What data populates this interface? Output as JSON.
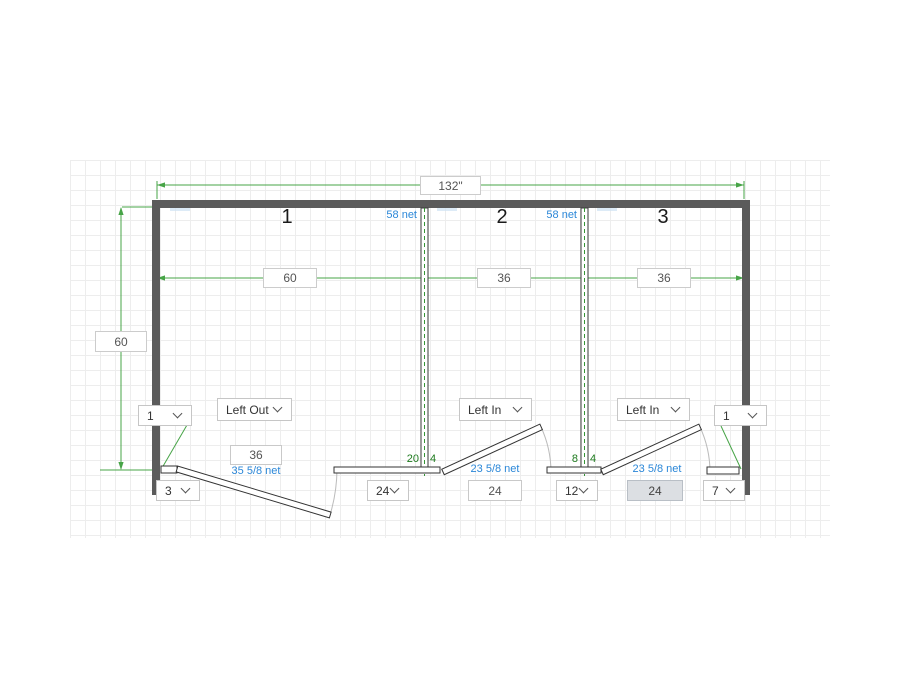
{
  "colors": {
    "wall_gray": "#5b5b5b",
    "dimension_green": "#47a447",
    "net_label_blue": "#2b87d8",
    "pilaster_label_green": "#1d7a1d",
    "selected_field_bg": "#dcdfe3"
  },
  "dimensions": {
    "overall_width": "132\"",
    "depth": "60",
    "stall_widths": [
      "60",
      "36",
      "36"
    ]
  },
  "stalls": [
    {
      "number": "1"
    },
    {
      "number": "2"
    },
    {
      "number": "3"
    }
  ],
  "partitions": [
    {
      "net_label": "58 net",
      "pilaster_left": "20",
      "pilaster_right": "4"
    },
    {
      "net_label": "58 net",
      "pilaster_left": "8",
      "pilaster_right": "4"
    }
  ],
  "doors": [
    {
      "swing": "Left Out",
      "width": "36",
      "net": "35 5/8 net"
    },
    {
      "swing": "Left In",
      "width": "24",
      "net": "23 5/8 net"
    },
    {
      "swing": "Left In",
      "width": "24",
      "net": "23 5/8 net"
    }
  ],
  "corner_fields": {
    "left": "1",
    "right": "1"
  },
  "filler_fields": {
    "left_end": "3",
    "panel_1": "24",
    "panel_2": "12",
    "right_end": "7"
  }
}
